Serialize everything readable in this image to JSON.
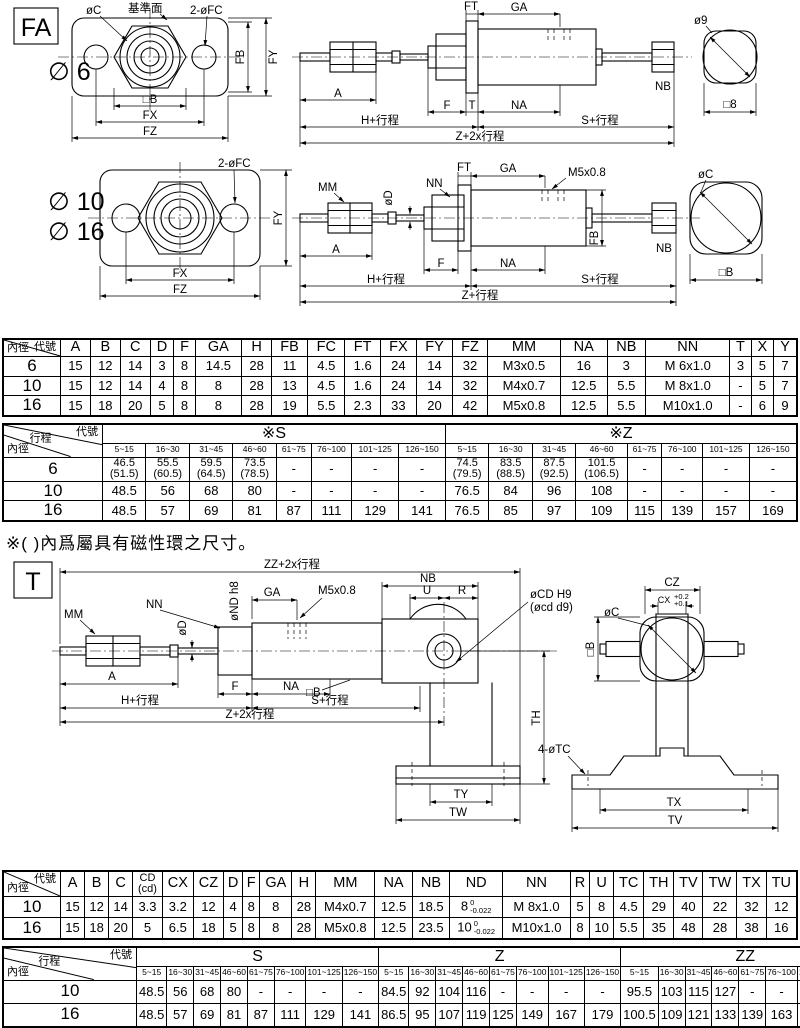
{
  "note": "※( )內爲屬具有磁性環之尺寸。",
  "lbl": {
    "fa_tag": "FA",
    "t_tag": "T",
    "bore6": "∅ 6",
    "bore10": "∅ 10",
    "bore16": "∅ 16",
    "oc": "øC",
    "datum": "基準面",
    "fc2": "2-øFC",
    "fb": "FB",
    "fy": "FY",
    "sqB": "□B",
    "fx": "FX",
    "fz": "FZ",
    "ft": "FT",
    "ga": "GA",
    "a": "A",
    "f": "F",
    "t": "T",
    "na": "NA",
    "nb": "NB",
    "h_stroke": "H+行程",
    "s_stroke": "S+行程",
    "z2_stroke": "Z+2x行程",
    "z_stroke": "Z+行程",
    "zz2_stroke": "ZZ+2x行程",
    "o9": "ø9",
    "sq8": "□8",
    "mm": "MM",
    "od": "øD",
    "nn": "NN",
    "m5": "M5x0.8",
    "ond": "øND h8",
    "u": "U",
    "r": "R",
    "ocd": "øCD H9",
    "ocd2": "(øcd d9)",
    "th": "TH",
    "ty": "TY",
    "tw": "TW",
    "cz": "CZ",
    "cx": "CX",
    "cx_t1": "+0.2",
    "cx_t2": "+0.1",
    "tc4": "4-øTC",
    "tx": "TX",
    "tv": "TV"
  },
  "tables": {
    "dim1": {
      "corner": [
        "代號",
        "內徑"
      ],
      "columns": [
        "A",
        "B",
        "C",
        "D",
        "F",
        "GA",
        "H",
        "FB",
        "FC",
        "FT",
        "FX",
        "FY",
        "FZ",
        "MM",
        "NA",
        "NB",
        "NN",
        "T",
        "X",
        "Y"
      ],
      "rows": [
        {
          "bore": "6",
          "values": [
            "15",
            "12",
            "14",
            "3",
            "8",
            "14.5",
            "28",
            "11",
            "4.5",
            "1.6",
            "24",
            "14",
            "32",
            "M3x0.5",
            "16",
            "3",
            "M 6x1.0",
            "3",
            "5",
            "7"
          ]
        },
        {
          "bore": "10",
          "values": [
            "15",
            "12",
            "14",
            "4",
            "8",
            "8",
            "28",
            "13",
            "4.5",
            "1.6",
            "24",
            "14",
            "32",
            "M4x0.7",
            "12.5",
            "5.5",
            "M 8x1.0",
            "-",
            "5",
            "7"
          ]
        },
        {
          "bore": "16",
          "values": [
            "15",
            "18",
            "20",
            "5",
            "8",
            "8",
            "28",
            "19",
            "5.5",
            "2.3",
            "33",
            "20",
            "42",
            "M5x0.8",
            "12.5",
            "5.5",
            "M10x1.0",
            "-",
            "6",
            "9"
          ]
        }
      ]
    },
    "stroke1": {
      "corner": [
        "代號",
        "行程",
        "內徑"
      ],
      "groups": [
        {
          "label": "※S"
        },
        {
          "label": "※Z"
        }
      ],
      "ranges": [
        "5~15",
        "16~30",
        "31~45",
        "46~60",
        "61~75",
        "76~100",
        "101~125",
        "126~150"
      ],
      "rows": [
        {
          "bore": "6",
          "values": [
            "46.5\n(51.5)",
            "55.5\n(60.5)",
            "59.5\n(64.5)",
            "73.5\n(78.5)",
            "-",
            "-",
            "-",
            "-",
            "74.5\n(79.5)",
            "83.5\n(88.5)",
            "87.5\n(92.5)",
            "101.5\n(106.5)",
            "-",
            "-",
            "-",
            "-"
          ]
        },
        {
          "bore": "10",
          "values": [
            "48.5",
            "56",
            "68",
            "80",
            "-",
            "-",
            "-",
            "-",
            "76.5",
            "84",
            "96",
            "108",
            "-",
            "-",
            "-",
            "-"
          ]
        },
        {
          "bore": "16",
          "values": [
            "48.5",
            "57",
            "69",
            "81",
            "87",
            "111",
            "129",
            "141",
            "76.5",
            "85",
            "97",
            "109",
            "115",
            "139",
            "157",
            "169"
          ]
        }
      ]
    },
    "dim2": {
      "corner": [
        "代號",
        "內徑"
      ],
      "columns": [
        "A",
        "B",
        "C",
        "CD\n(cd)",
        "CX",
        "CZ",
        "D",
        "F",
        "GA",
        "H",
        "MM",
        "NA",
        "NB",
        "ND",
        "NN",
        "R",
        "U",
        "TC",
        "TH",
        "TV",
        "TW",
        "TX",
        "TU"
      ],
      "rows": [
        {
          "bore": "10",
          "values": [
            "15",
            "12",
            "14",
            "3.3",
            "3.2",
            "12",
            "4",
            "8",
            "8",
            "28",
            "M4x0.7",
            "12.5",
            "18.5",
            {
              "v": "8",
              "tt": "0",
              "tb": "-0.022"
            },
            "M 8x1.0",
            "5",
            "8",
            "4.5",
            "29",
            "40",
            "22",
            "32",
            "12"
          ]
        },
        {
          "bore": "16",
          "values": [
            "15",
            "18",
            "20",
            "5",
            "6.5",
            "18",
            "5",
            "8",
            "8",
            "28",
            "M5x0.8",
            "12.5",
            "23.5",
            {
              "v": "10",
              "tt": "0",
              "tb": "-0.022"
            },
            "M10x1.0",
            "8",
            "10",
            "5.5",
            "35",
            "48",
            "28",
            "38",
            "16"
          ]
        }
      ]
    },
    "stroke2": {
      "corner": [
        "代號",
        "行程",
        "內徑"
      ],
      "groups": [
        {
          "label": "S"
        },
        {
          "label": "Z"
        },
        {
          "label": "ZZ"
        }
      ],
      "ranges": [
        "5~15",
        "16~30",
        "31~45",
        "46~60",
        "61~75",
        "76~100",
        "101~125",
        "126~150"
      ],
      "rows": [
        {
          "bore": "10",
          "values": [
            "48.5",
            "56",
            "68",
            "80",
            "-",
            "-",
            "-",
            "-",
            "84.5",
            "92",
            "104",
            "116",
            "-",
            "-",
            "-",
            "-",
            "95.5",
            "103",
            "115",
            "127",
            "-",
            "-",
            "-",
            "-"
          ]
        },
        {
          "bore": "16",
          "values": [
            "48.5",
            "57",
            "69",
            "81",
            "87",
            "111",
            "129",
            "141",
            "86.5",
            "95",
            "107",
            "119",
            "125",
            "149",
            "167",
            "179",
            "100.5",
            "109",
            "121",
            "133",
            "139",
            "163",
            "181",
            "193"
          ]
        }
      ]
    }
  }
}
